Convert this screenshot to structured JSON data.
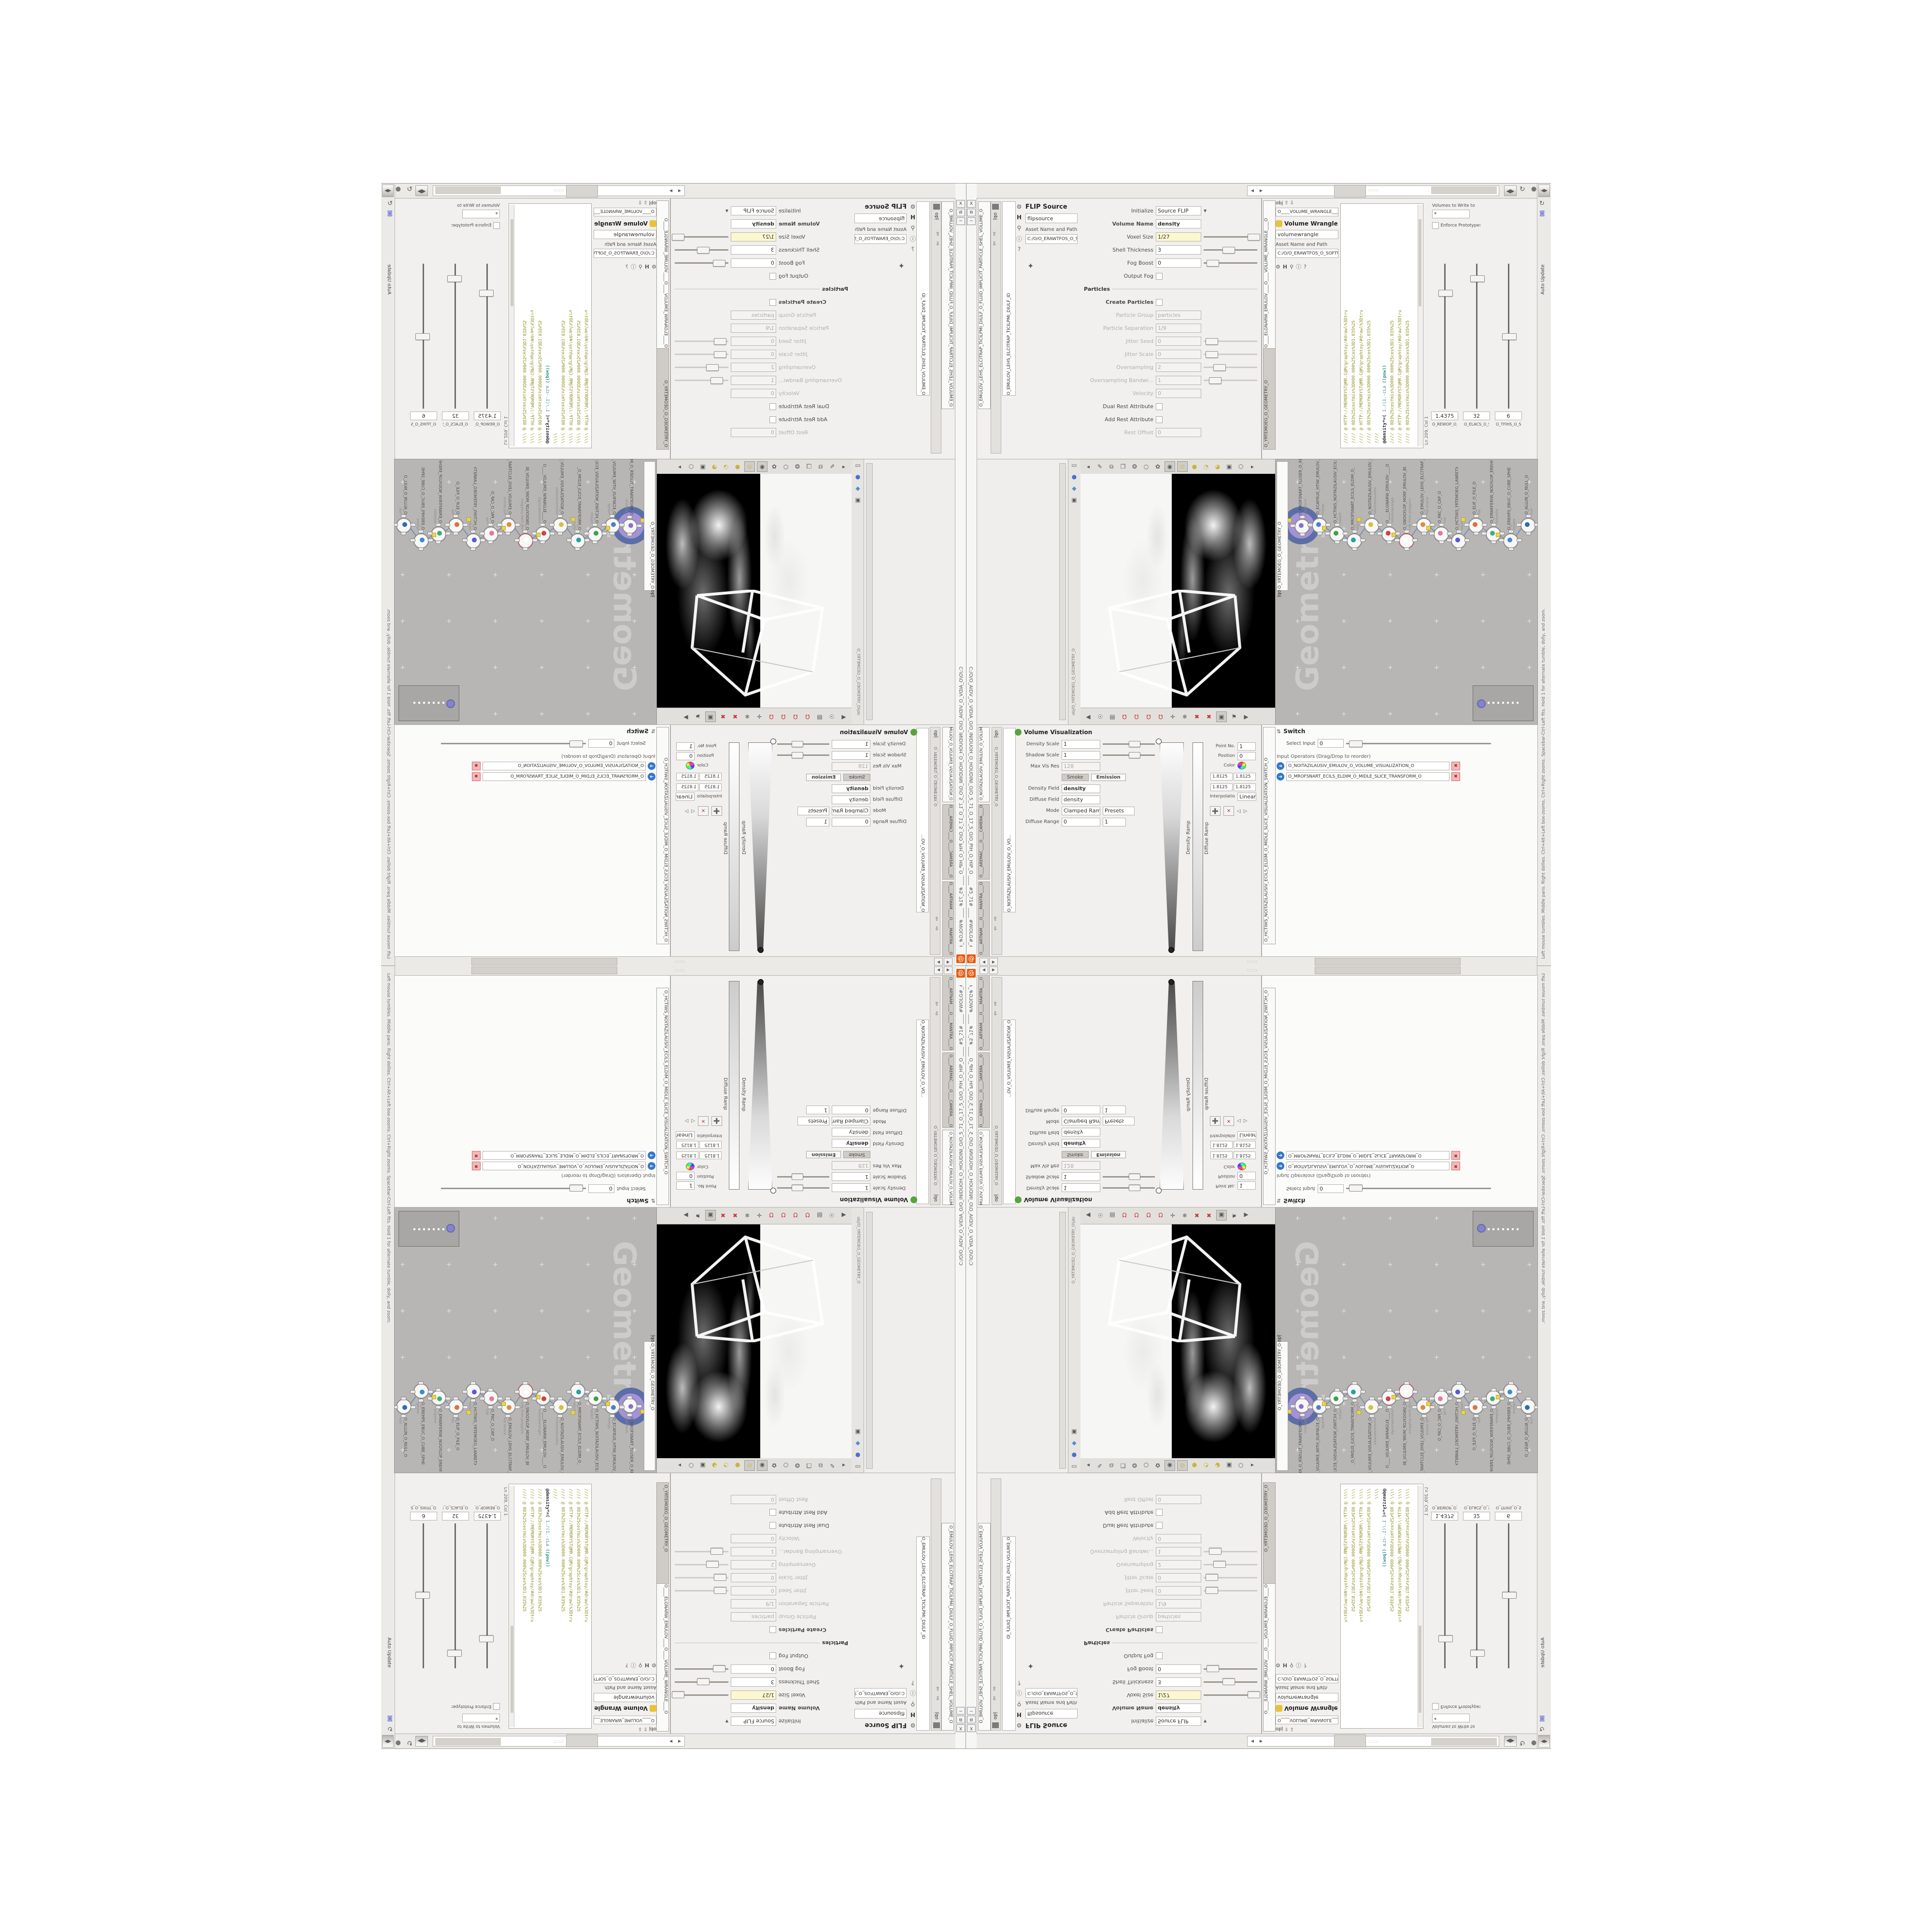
{
  "window": {
    "title": "C:/O/O_AIDV_O_VIDIA_O/O_INIDUOH_O_HOUDINI_O/O_5_71_O_17_5_O/O_PIH_O_HIP_O ____ #5_71# ____ #WOLG#_#GLOW#",
    "close_label": "X",
    "restore_label": "⧉",
    "min_label": "─",
    "logo_color": "#e8590c"
  },
  "status_bar": {
    "text": "Left mouse tumbles.  Middle pans.  Right dollies.  Ctrl+Alt+Left box-zooms.  Ctrl+Right zooms.  Spacebar-Ctrl-Left fits.  Hold 1 for alternate tumble, dolly, and zoom."
  },
  "breadcrumb": {
    "root": "obj"
  },
  "flip_source": {
    "tab": "O_EMULOV_LEHS_ELCITRAP_TICILPMI_DIULF_O_FLUID_IMPLICIT_PARTICLE_SHEL_VOLUME_O",
    "node_combo": "O_EMULOV_LEHS_ELCITRAP_TICILPMI_DIULF_ID",
    "title": "FLIP Source",
    "name": "flipsource",
    "asset_label": "Asset Name and Path",
    "path": "C:/O/O_ERAWTFOS_O_SOFTWARE_O...",
    "params": [
      {
        "label": "Initialize",
        "value": "Source FLIP",
        "combo": true
      },
      {
        "label": "Volume Name",
        "value": "density",
        "bold": true
      },
      {
        "label": "Voxel Size",
        "value": "1/27",
        "yellow": true,
        "slider": 0.82
      },
      {
        "label": "Shell Thickness",
        "value": "3",
        "slider": 0.35
      },
      {
        "label": "Fog Boost",
        "value": "0",
        "slider": 0.05
      },
      {
        "label": "Output Fog",
        "checkbox": true
      },
      {
        "label": "Particles",
        "section": true
      },
      {
        "label": "Create Particles",
        "checkbox": true,
        "bold": true
      },
      {
        "label": "Particle Group",
        "value": "particles",
        "dim": true
      },
      {
        "label": "Particle Separation",
        "value": "1/9",
        "dim": true
      },
      {
        "label": "Jitter Seed",
        "value": "0",
        "dim": true,
        "slider": 0.04
      },
      {
        "label": "Jitter Scale",
        "value": "0",
        "dim": true,
        "slider": 0.04
      },
      {
        "label": "Oversampling",
        "value": "2",
        "dim": true,
        "slider": 0.18
      },
      {
        "label": "Oversampling Bandwi...",
        "value": "1",
        "dim": true,
        "slider": 0.1
      },
      {
        "label": "Velocity",
        "value": "0",
        "dim": true
      },
      {
        "label": "Dual Rest Attribute",
        "checkbox": true
      },
      {
        "label": "Add Rest Attribute",
        "checkbox": true
      },
      {
        "label": "Rest Offset",
        "value": "0",
        "dim": true
      }
    ]
  },
  "volume_wrangle": {
    "tab1": "O____ELGNARW_EMULOV____O____VOLUME_WRANGLE____O",
    "tab2": "O_YRTEMOEG_O_GEOMETRY_O",
    "node_combo": "O____VOLUME_WRANGLE____O",
    "title": "Volume Wrangle",
    "name": "volumewrangle",
    "asset_label": "Asset Name and Path",
    "path": "C:/O/O_ERAWTFOS_O_SOFTWARE_O...",
    "code": [
      "//// @ HTTP://MEMORYST@MR.C@M/graphtoy/#drawl%3Dtru",
      "//// @ 0D3%25cesYmis%3D000.000%25ces%3D1.035%25",
      "//// @ HTTP://MEMORYST@MR.C@M/graphtoy/#drawl%3Dtru",
      "//// @ 0D3%25cesYmis%3D000.000%25ces%3D1.035%25",
      "////",
      "@density*=( 1./(1.-cLa ((pow))",
      "//// @ 0D3%25cesYmis%3D000.000%25ces%3D1.035%25",
      "//// @ HTTP://MEMORYST@MR.C@M/graphtoy/#drawl%3Dtru",
      "//// @ 0D3%25cesYmis%3D000.000%25ces%3D1.035%25"
    ],
    "line_col": "Ln 209, Col 1",
    "writeto_label": "Volumes to Write to",
    "writeto_value": "*",
    "enforce_label": "Enforce Prototypes",
    "spare": [
      {
        "label": "O_REWOP_O_POWER_O",
        "value": "1.4375",
        "pos": 0.18
      },
      {
        "label": "O_ELACS_O_SCALE_O",
        "value": "32",
        "pos": 0.08
      },
      {
        "label": "O_TFIHS_O_SHIFT_O",
        "value": "6",
        "pos": 0.48
      }
    ],
    "auto_update": "Auto Update"
  },
  "network": {
    "watermark": "Geometry",
    "tab": "O_YRTEMOEG_O_GEOMETRY_O",
    "nodes": [
      {
        "name": "O_MROFSNART_TLUSER_O_RESULT_TRANSFORM_O",
        "sub": "transform",
        "color": "#8a6fd0",
        "big": true
      },
      {
        "name": "O_ECAFRUS_HTIW_EMULOV_EGREM_O_MERGE_VOLUME_WITH_SURFACE_O",
        "sub": "merge",
        "color": "#4a7fd4"
      },
      {
        "name": "O_HCTIWS_NOITAZILAUSIV_ECILS_ELDIM_O",
        "sub": "switch",
        "color": "#3fa04a"
      },
      {
        "name": "O_MROFSNART_ECILS_ELDIM_O_MIDLE_SLICE_TRANSFORM_O",
        "sub": "xform",
        "color": "#2aa0a0"
      },
      {
        "name": "O_NOITAZILAUSIV_EMULOV_O_VOLUME_VISUALIZATION_O",
        "sub": "volumevisualiza",
        "color": "#d4c13f"
      },
      {
        "name": "O____ELGNARW_EMULOV____O",
        "sub": "volumewrangle",
        "color": "#cc4444"
      },
      {
        "name": "O_SNOGYLOP_MORF_EMULOV_BDV_O_VDB_VOLUME_FROM_POLYGONS_O",
        "sub": "vdb from polygons",
        "color": "#ffffff",
        "ring": "#b06060"
      },
      {
        "name": "O_EMULOV_LEHS_ELCITRAP_TICILPMI_DIULF_O",
        "sub": "flip source",
        "color": "#e08a3c"
      },
      {
        "name": "O_PAC_O_CAP_O",
        "sub": "cap",
        "color": "#e07a9a"
      },
      {
        "name": "O_HCTIWS_YRTEMOEG_LANRETXE_O_EXTERNAL_GEOMETRY_SWITCH_O",
        "sub": "switch",
        "color": "#5a5ad4"
      },
      {
        "name": "O_ELIF_O_FILE_O",
        "sub": "file",
        "color": "#e0703c"
      },
      {
        "name": "O_EMARFERIW_NOGYLOP_EREHPS_O_SPHERE_POLYGON_WIREFRAME_O",
        "sub": "polywire",
        "color": "#44aa77"
      },
      {
        "name": "O_EREHPS_EBUC_O_CUBE_SPHERE_O",
        "sub": "sphere",
        "color": "#3f8ad4"
      },
      {
        "name": "O_ALLUN_O_NULL_O",
        "sub": "null",
        "color": "#2a6fb0"
      }
    ]
  },
  "viewport": {
    "tab": "obj/O_YRTEMOEG_O_GEOMETRY_O",
    "top_icons": [
      "◂",
      "✎",
      "⧉",
      "❐",
      "❂",
      "○",
      "✿",
      "◉",
      "⊙",
      "●",
      "◔",
      "◕",
      "▣",
      "⬡",
      "▸"
    ],
    "top_icon_names": [
      "back",
      "select",
      "layout-cards",
      "layout-card",
      "molecule",
      "circle",
      "hands",
      "globe-shade",
      "headlight",
      "bulb-on",
      "bulb-half",
      "bulb-dim",
      "image-plane",
      "diamond",
      "forward"
    ],
    "bottom_icons": [
      "◀",
      "☉",
      "▤",
      "Ω",
      "Ω",
      "Ω",
      "Ω",
      "✛",
      "❄",
      "✖",
      "✖",
      "▣",
      "⚑",
      "▶"
    ],
    "bottom_icon_names": [
      "back",
      "pin",
      "notes",
      "magnet-grid",
      "magnet-prim",
      "magnet-point",
      "magnet-multi",
      "axis-gizmo",
      "snowflake",
      "red-cross-a",
      "red-cross-b",
      "view-box",
      "flag",
      "forward"
    ]
  },
  "volume_visualization": {
    "tabs": [
      {
        "label": "O_NOITAZILAUSIV_EMULOV_O_VOLUME_VISUALIZATION_O",
        "on": true
      },
      {
        "label": "O____AREMAC____O____CAMERA____O",
        "on": false
      },
      {
        "label": "O____ARTNAM____O____MANTRA____O",
        "on": false
      }
    ],
    "geo_path": "O_YRTEMOEG_O_GEOMETRY_O",
    "node_combo": "O_NOITAZILAUSIV_EMULOV_O_VO...",
    "title": "Volume Visualization",
    "density_scale_label": "Density Scale",
    "density_scale": "1",
    "shadow_scale_label": "Shadow Scale",
    "shadow_scale": "1",
    "maxvis_label": "Max Vis Res",
    "maxvis": "128",
    "tab_smoke": "Smoke",
    "tab_emission": "Emission",
    "density_field_label": "Density Field",
    "density_field": "density",
    "diffuse_field_label": "Diffuse Field",
    "diffuse_field": "density",
    "mode_label": "Mode",
    "mode": "Clamped Ramp",
    "presets_label": "Presets",
    "density_ramp_label": "Density Ramp",
    "diffuse_range_label": "Diffuse Range",
    "diffuse_range_lo": "0",
    "diffuse_range_hi": "1",
    "diffuse_ramp_label": "Diffuse Ramp",
    "point_no_label": "Point No.",
    "point_no": "1",
    "position_label": "Position",
    "position": "0",
    "color_label": "Color",
    "color_values": [
      "1.8125",
      "1.8125",
      "1.8125",
      "1.8125"
    ],
    "interp_label": "Interpolation",
    "interp": "Linear"
  },
  "switch_pane": {
    "tab": "O_HCTIWS_NOITAZILAUSIV_ECILS_ELDIM_O_MIDLE_SLICE_VISUALIZATION_SWITCH_O",
    "title": "Switch",
    "select_label": "Select Input",
    "select_value": "0",
    "ops_label": "Input Operators (Drag/Drop to reorder)",
    "items": [
      "O_NOITAZILAUSIV_EMULOV_O_VOLUME_VISUALIZATION_O",
      "O_MROFSNART_ECILS_ELDIM_O_MIDLE_SLICE_TRANSFORM_O"
    ]
  },
  "colors": {
    "network_bg": "#b7b6b4",
    "wire": "#7a8fb5",
    "selection_outer": "#5b6ea6",
    "selection_inner": "#a492d6",
    "code_olive": "#8f8f23",
    "code_teal": "#2e8b8b",
    "yellow_field": "#fbf8cf",
    "red_btn": "#cc3333",
    "blue_arrow": "#3377cc"
  }
}
